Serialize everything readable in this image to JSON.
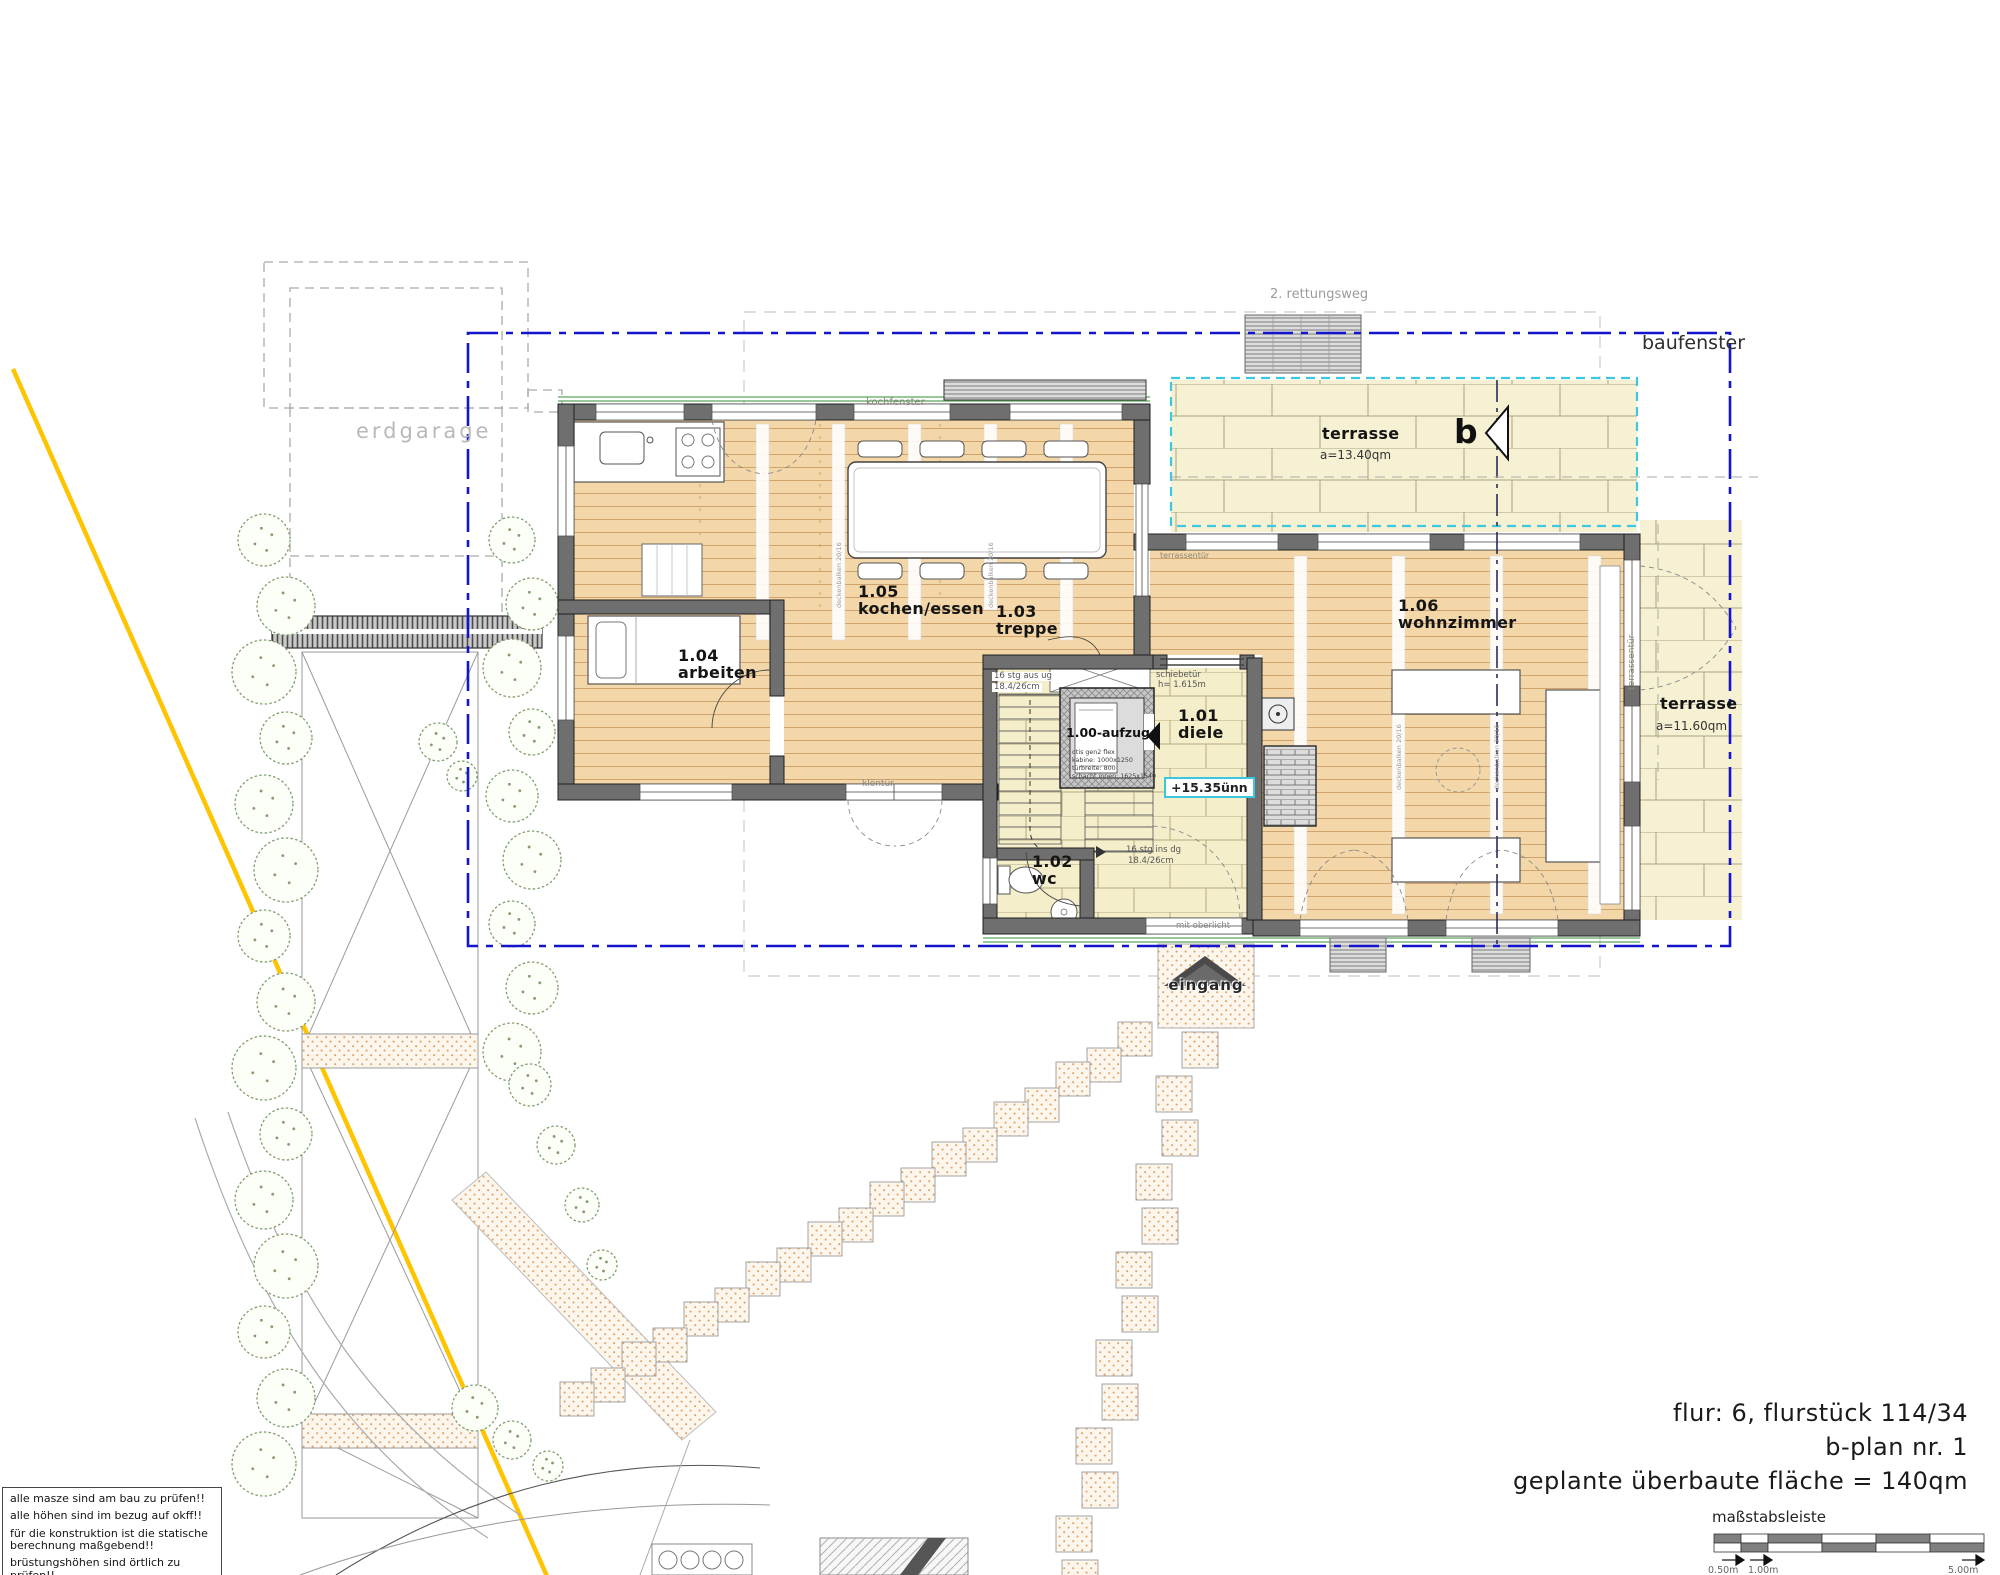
{
  "plan": {
    "site": {
      "erdgarage": "erdgarage",
      "rettungsweg": "2. rettungsweg",
      "baufenster": "baufenster",
      "eingang": "eingang",
      "mit_oberlicht": "mit oberlicht",
      "section_marker": "b"
    },
    "rooms": [
      {
        "num": "1.00-aufzug",
        "name": "",
        "specs": [
          "otis gen2 flex",
          "kabine: 1000x1250",
          "türbreite: 800",
          "schacht innen: 1625x1540"
        ]
      },
      {
        "num": "1.01",
        "name": "diele"
      },
      {
        "num": "1.02",
        "name": "wc"
      },
      {
        "num": "1.03",
        "name": "treppe"
      },
      {
        "num": "1.04",
        "name": "arbeiten"
      },
      {
        "num": "1.05",
        "name": "kochen/essen"
      },
      {
        "num": "1.06",
        "name": "wohnzimmer"
      }
    ],
    "terraces": [
      {
        "name": "terrasse",
        "area": "a=13.40qm"
      },
      {
        "name": "terrasse",
        "area": "a=11.60qm"
      }
    ],
    "level_tag": "+15.35ünn",
    "annotations": {
      "kochfenster": "kochfenster",
      "kloentuer": "klöntür",
      "terrassentuer": "terrassentür",
      "schiebetuer": "schiebetür",
      "schiebetuer_h": "h= 1.615m",
      "stairs_up": "16 stg aus ug",
      "stairs_up_dim": "18.4/26cm",
      "stairs_dg": "16 stg ins dg",
      "stairs_dg_dim": "18.4/26cm",
      "deckenbalken": "deckenbalken 20/16"
    }
  },
  "notes": [
    "alle masze sind am bau zu prüfen!!",
    "alle höhen sind im bezug auf okff!!",
    "für die konstruktion ist die statische berechnung maßgebend!!",
    "brüstungshöhen sind örtlich zu prüfen!!"
  ],
  "title_block": {
    "line1": "flur: 6, flurstück 114/34",
    "line2": "b-plan nr. 1",
    "line3": "geplante überbaute fläche = 140qm"
  },
  "scale_bar": {
    "label": "maßstabsleiste",
    "tick_050": "0.50m",
    "tick_100": "1.00m",
    "tick_500": "5.00m"
  },
  "colors": {
    "baufenster_line": "#1414cc",
    "terrace_outline": "#3cc9de",
    "survey_line": "#ffc400",
    "wood_floor": "#f3d7a8",
    "tile_floor": "#f4eecb",
    "terrace_floor": "#f7f1d3"
  }
}
